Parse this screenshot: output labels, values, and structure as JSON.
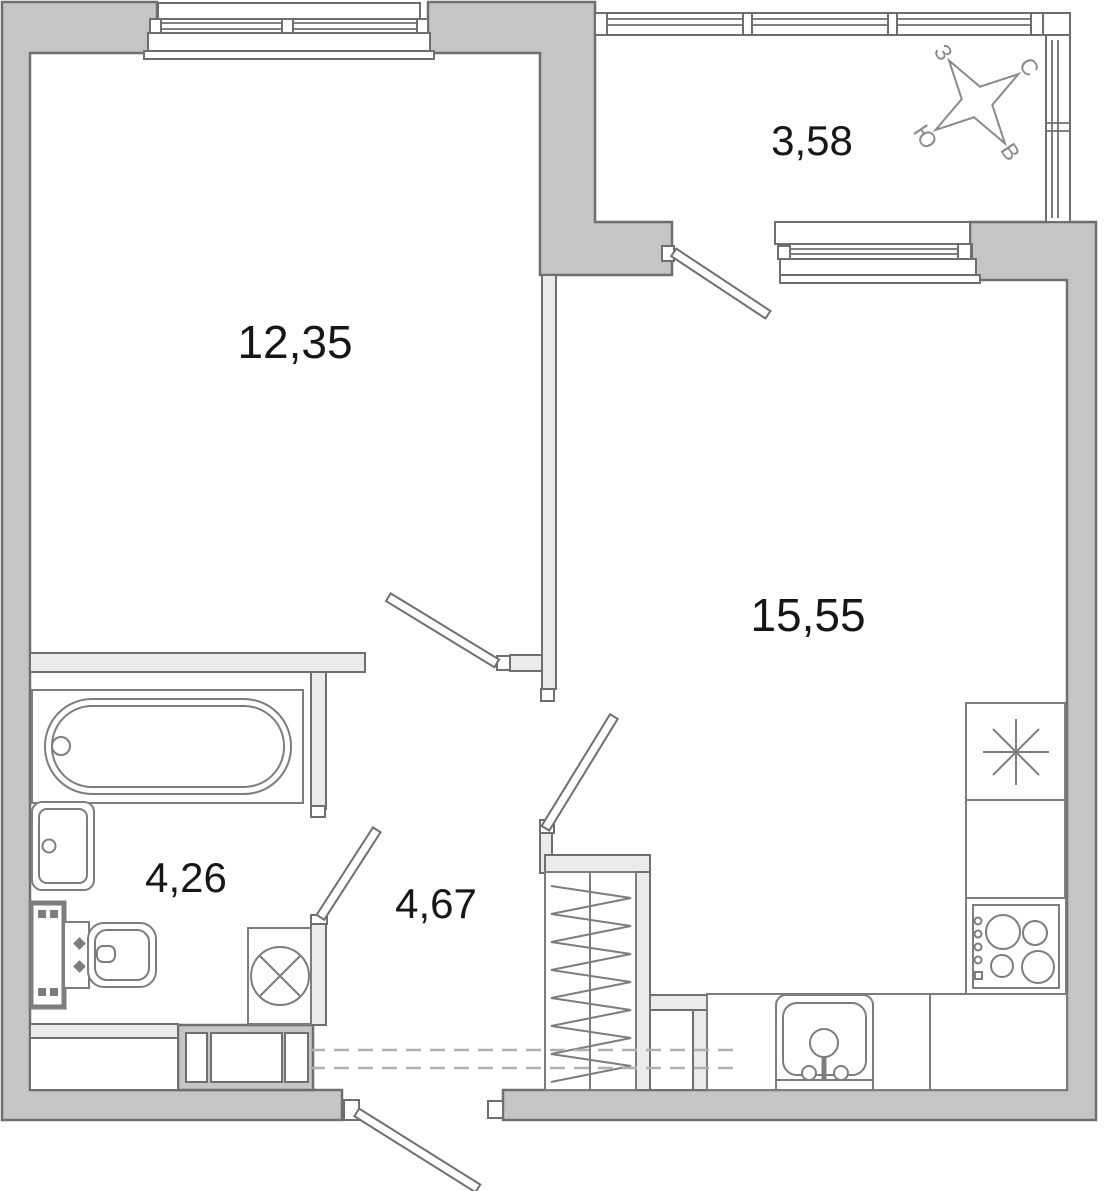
{
  "plan": {
    "rooms": [
      {
        "id": "room",
        "area_label": "12,35"
      },
      {
        "id": "balcony",
        "area_label": "3,58"
      },
      {
        "id": "kitchen-living",
        "area_label": "15,55"
      },
      {
        "id": "bathroom",
        "area_label": "4,26"
      },
      {
        "id": "hallway",
        "area_label": "4,67"
      }
    ],
    "compass": {
      "north_label": "С",
      "south_label": "Ю",
      "west_label": "З",
      "east_label": "В"
    },
    "fixtures": [
      "bathtub",
      "washbasin",
      "toilet",
      "washing-machine",
      "wardrobe",
      "duct-shaft",
      "fridge",
      "kitchen-counter",
      "stove",
      "kitchen-sink",
      "mezzanine-dashed-line"
    ],
    "colors": {
      "wall_fill": "#c5c5c5",
      "wall_outline": "#6f6f6f",
      "partition_fill": "#ebebeb",
      "fixture_stroke": "#7d7d7d",
      "label_color": "#161616",
      "dash_color": "#b0b0b0",
      "compass_color": "#8a8a8a",
      "background": "#ffffff"
    }
  }
}
